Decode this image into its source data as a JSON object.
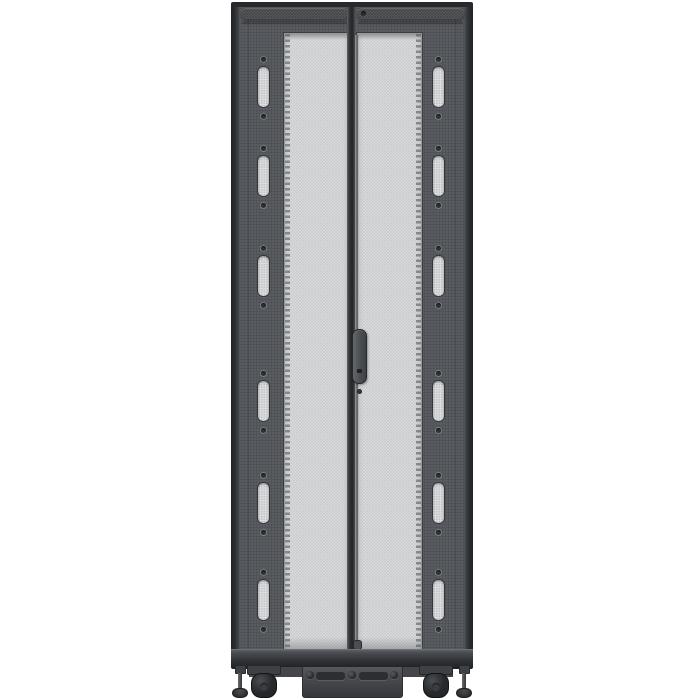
{
  "scene": {
    "type": "product-photo",
    "description": "Front view of a dark gray server rack enclosure with two split perforated mesh doors, center door handle with latch rod, six cable-access slots on each side column, perforated top vent strips, bottom rail with center access panel, casters and leveling feet, on a plain white background",
    "visible_text": ""
  },
  "colors": {
    "bg": "#ffffff",
    "cap": "#28292b",
    "frame": "#54575b",
    "frame_edge": "#202224",
    "strip": "#63666b",
    "strip_dot": "#454749",
    "mesh": "#e9eaec",
    "mesh_dot": "#c6c8ca",
    "mesh_border": "#96989b",
    "slot_fill": "#dcddde",
    "slot_dot": "#2e3032",
    "seam": "#232527",
    "rod": "#9a9da0",
    "handle": "#4c4e52",
    "handle_border": "#26282a",
    "rail_dark": "#1d1f21",
    "under": "#44464a",
    "panel": "#46484c",
    "wheel": "#222426",
    "foot": "#2b2d2f"
  },
  "rack": {
    "door_count": 2,
    "slot_columns": 2,
    "slots_per_column": 6,
    "side_slots": [
      {
        "top": 62
      },
      {
        "top": 151
      },
      {
        "top": 251
      },
      {
        "top": 376
      },
      {
        "top": 478
      },
      {
        "top": 575
      }
    ],
    "panel_vents": [
      {
        "left": 13
      },
      {
        "left": 56
      }
    ],
    "panel_bolts": [
      {
        "left": 3
      },
      {
        "left": 45
      },
      {
        "left": 87
      }
    ],
    "caster_count": 2,
    "leveling_foot_count": 2
  }
}
